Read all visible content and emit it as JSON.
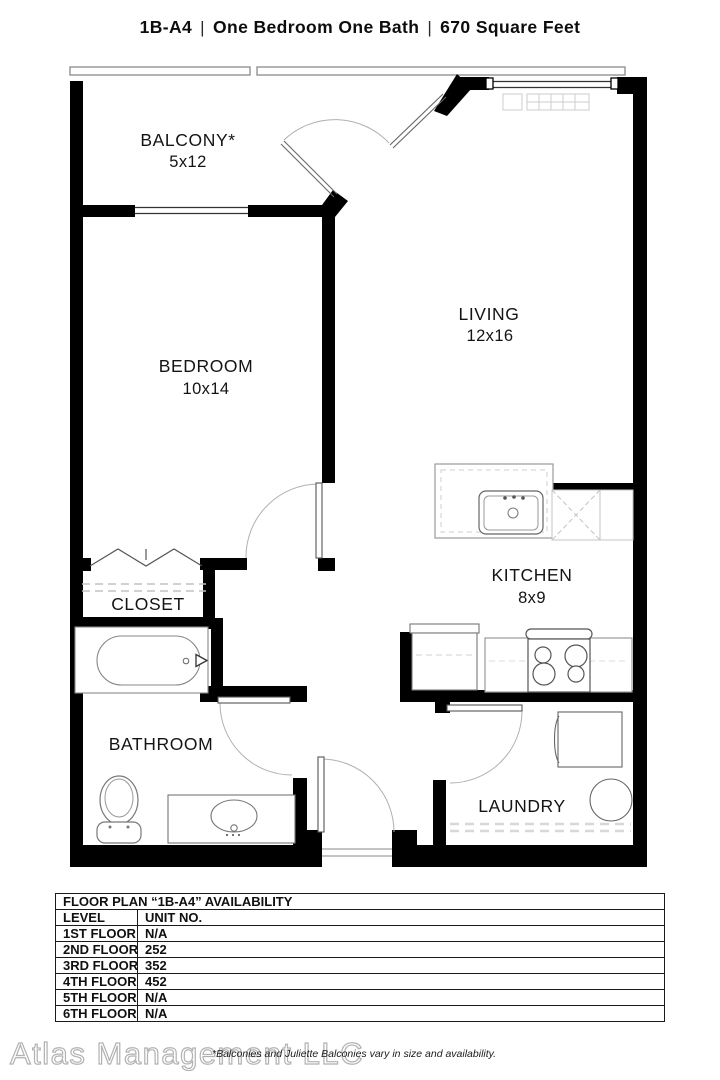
{
  "header": {
    "unit_code": "1B-A4",
    "separator": "|",
    "description": "One Bedroom One Bath",
    "area": "670 Square Feet"
  },
  "floor_plan": {
    "rooms": [
      {
        "name": "BALCONY*",
        "dims": "5x12"
      },
      {
        "name": "BEDROOM",
        "dims": "10x14"
      },
      {
        "name": "LIVING",
        "dims": "12x16"
      },
      {
        "name": "CLOSET",
        "dims": ""
      },
      {
        "name": "BATHROOM",
        "dims": ""
      },
      {
        "name": "KITCHEN",
        "dims": "8x9"
      },
      {
        "name": "LAUNDRY",
        "dims": ""
      }
    ],
    "colors": {
      "wall": "#000000",
      "fixture_line": "#666666",
      "swing_arc": "#b0b0b0",
      "light_detail": "#cccccc"
    }
  },
  "availability_table": {
    "title": "FLOOR PLAN “1B-A4” AVAILABILITY",
    "columns": [
      "LEVEL",
      "UNIT NO."
    ],
    "rows": [
      {
        "level": "1ST FLOOR",
        "unit": "N/A"
      },
      {
        "level": "2ND FLOOR",
        "unit": "252"
      },
      {
        "level": "3RD FLOOR",
        "unit": "352"
      },
      {
        "level": "4TH FLOOR",
        "unit": "452"
      },
      {
        "level": "5TH FLOOR",
        "unit": "N/A"
      },
      {
        "level": "6TH FLOOR",
        "unit": "N/A"
      }
    ]
  },
  "footer": {
    "watermark": "Atlas Management LLC",
    "disclaimer": "*Balconies and Juliette Balconies vary in size and availability."
  }
}
